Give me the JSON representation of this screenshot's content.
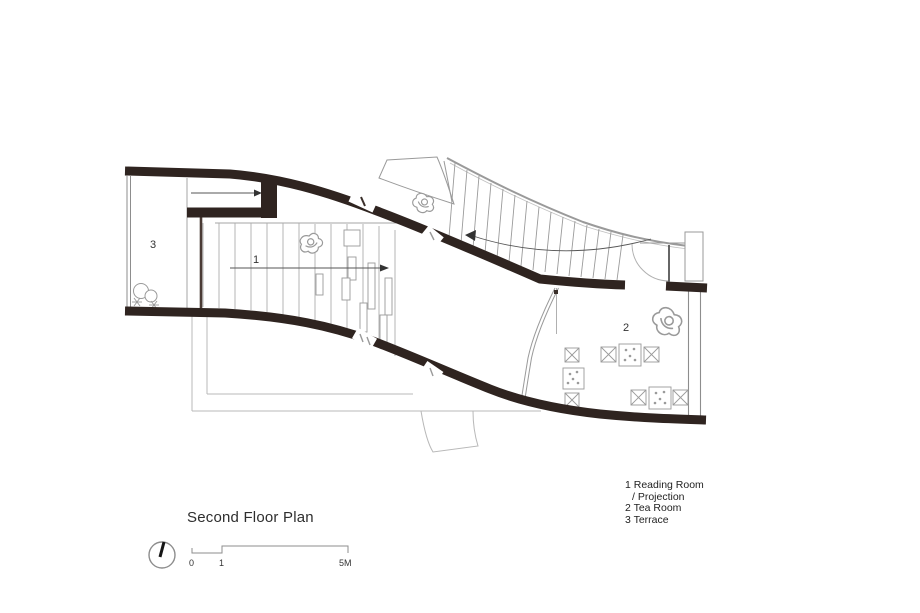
{
  "title": "Second Floor Plan",
  "room_labels": {
    "reading_room": "1",
    "tea_room": "2",
    "terrace": "3"
  },
  "legend": {
    "lines": [
      "1 Reading Room",
      "/ Projection",
      "2 Tea Room",
      "3 Terrace"
    ]
  },
  "scale_bar": {
    "start": "0",
    "mid": "1",
    "end": "5M"
  },
  "icons": {
    "north": "north-arrow-icon"
  },
  "colors": {
    "wall": "#2f2420",
    "light_line": "#a0a0a0",
    "text": "#2e2e2e"
  }
}
